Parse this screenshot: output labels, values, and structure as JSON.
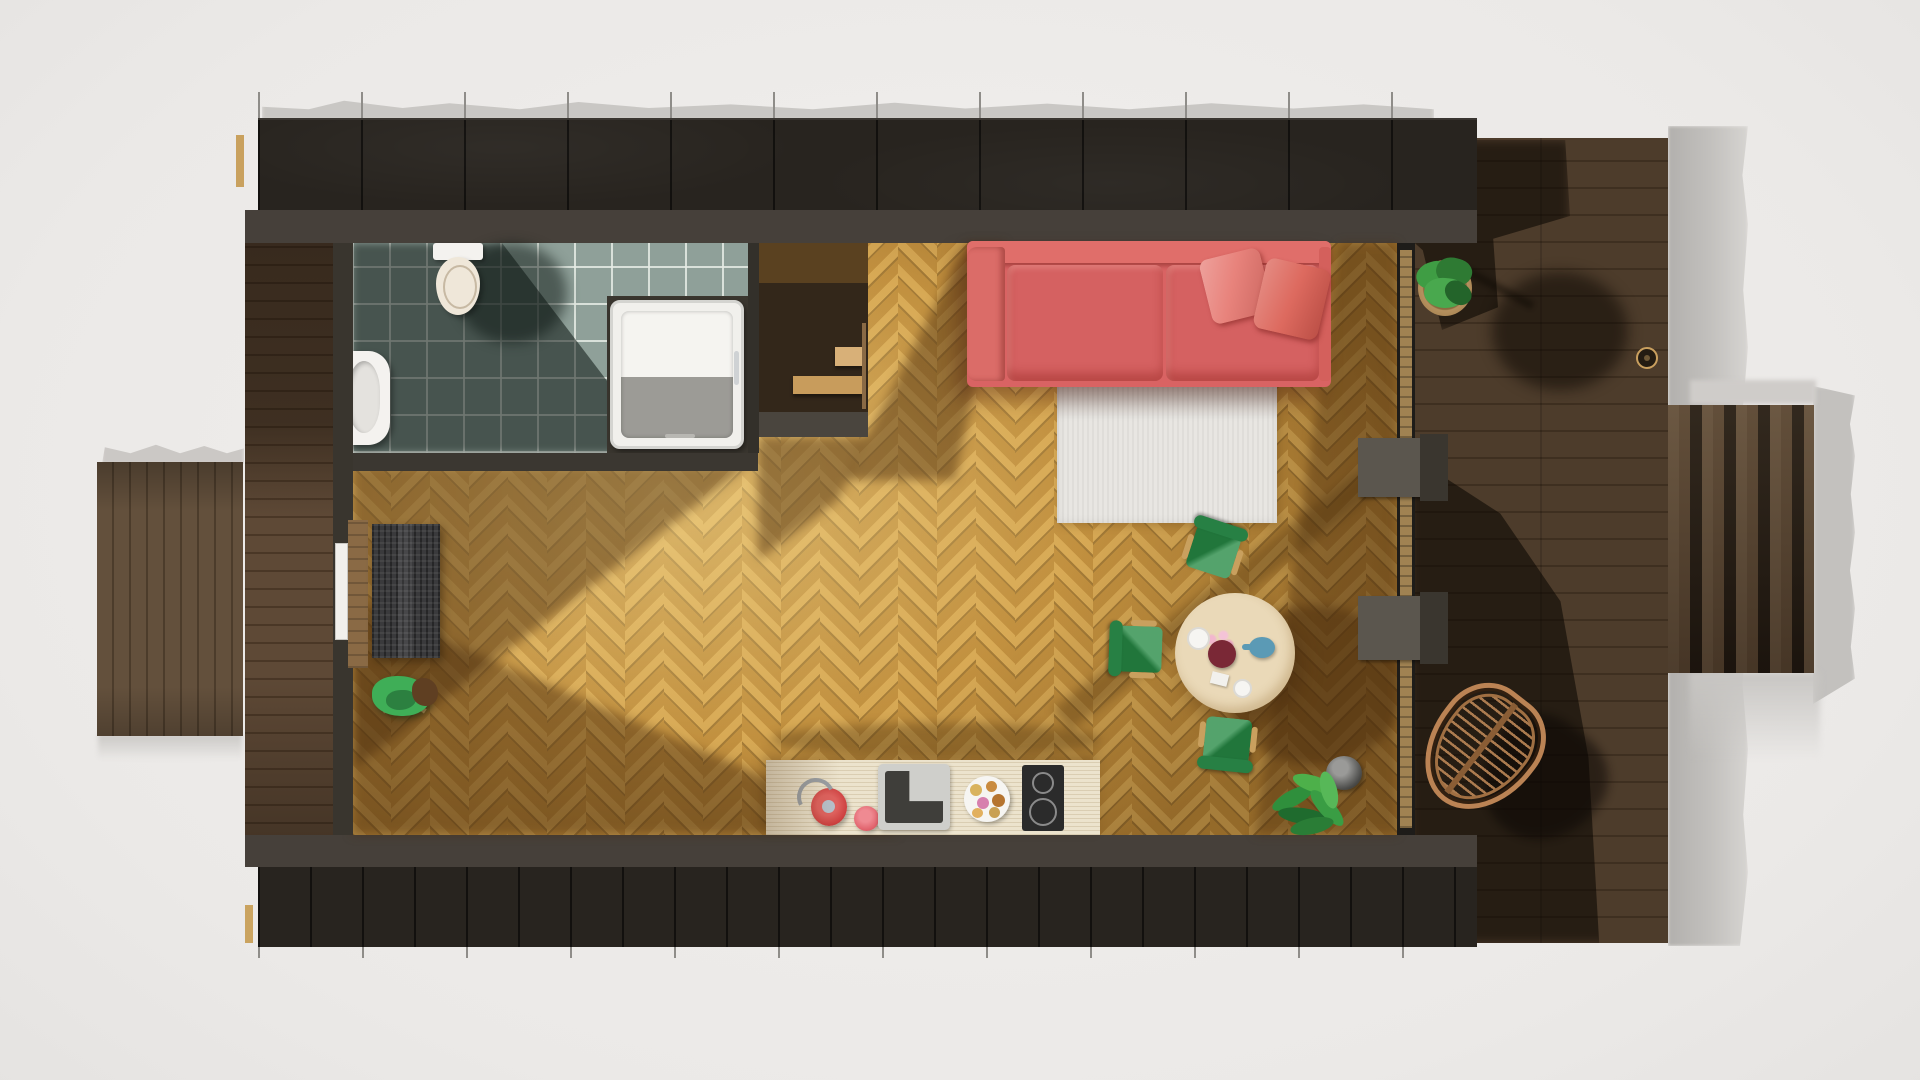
{
  "meta": {
    "title": "Top-down 3D rendered floor plan of a small cabin studio apartment",
    "view": "orthographic top view, afternoon sun casting shadows to the lower-right",
    "canvas": {
      "width": 1920,
      "height": 1080
    }
  },
  "scene": {
    "rooms": [
      {
        "name": "bathroom",
        "position": "top-left",
        "floor": "square grey-green ceramic tiles",
        "fixtures": [
          "toilet",
          "wall-hung-sink",
          "shower-tray"
        ]
      },
      {
        "name": "living-dining-kitchen",
        "position": "center",
        "floor": "oak herringbone parquet",
        "furniture": [
          "red-sofa",
          "white-rug",
          "round-dining-table",
          "three-green-chairs",
          "kitchen-counter",
          "potted-plant",
          "doormat",
          "coat-stand"
        ]
      },
      {
        "name": "staircase",
        "position": "top-center-left",
        "details": [
          "two wooden treads",
          "dark stairwell",
          "grey parapet"
        ]
      },
      {
        "name": "terrace-deck",
        "position": "right",
        "floor": "dark stained wood planks",
        "furniture": [
          "rattan-hanging-chair",
          "potted-plant",
          "small-lantern"
        ]
      }
    ],
    "exterior": [
      {
        "name": "black-cladding-band-top"
      },
      {
        "name": "black-cladding-band-bottom"
      },
      {
        "name": "left-deck-strip"
      },
      {
        "name": "left-slat-wing"
      },
      {
        "name": "right-slat-wing"
      },
      {
        "name": "entrance-door-west",
        "door_color": "white"
      },
      {
        "name": "glass-wall-east",
        "stubs": 2
      }
    ],
    "tabletop_items": [
      "flower-bowl",
      "blue-teapot",
      "white-plate",
      "white-cup",
      "paper-card"
    ],
    "counter_items": [
      "red-kettle",
      "pink-pot",
      "square-sink",
      "pastry-plate",
      "induction-cooktop-2-rings"
    ]
  },
  "palette": {
    "bg": "#efedeb",
    "cladding": "#28241f",
    "wallband": "#46403a",
    "deck": "#4d3c2b",
    "strip": "#5e4936",
    "wing": "#63503c",
    "parquet": "#c6933f",
    "tile": "#8fa099",
    "sofa": "#d96363",
    "pillow": "#e8837c",
    "rug": "#e8e6e2",
    "table": "#ead9b8",
    "green": "#2f8f4c",
    "counter": "#ece3cd",
    "cooktop": "#2b2b2b",
    "rattan": "#bb8354",
    "sill": "#a08252",
    "jamb": "#8a6a45"
  }
}
